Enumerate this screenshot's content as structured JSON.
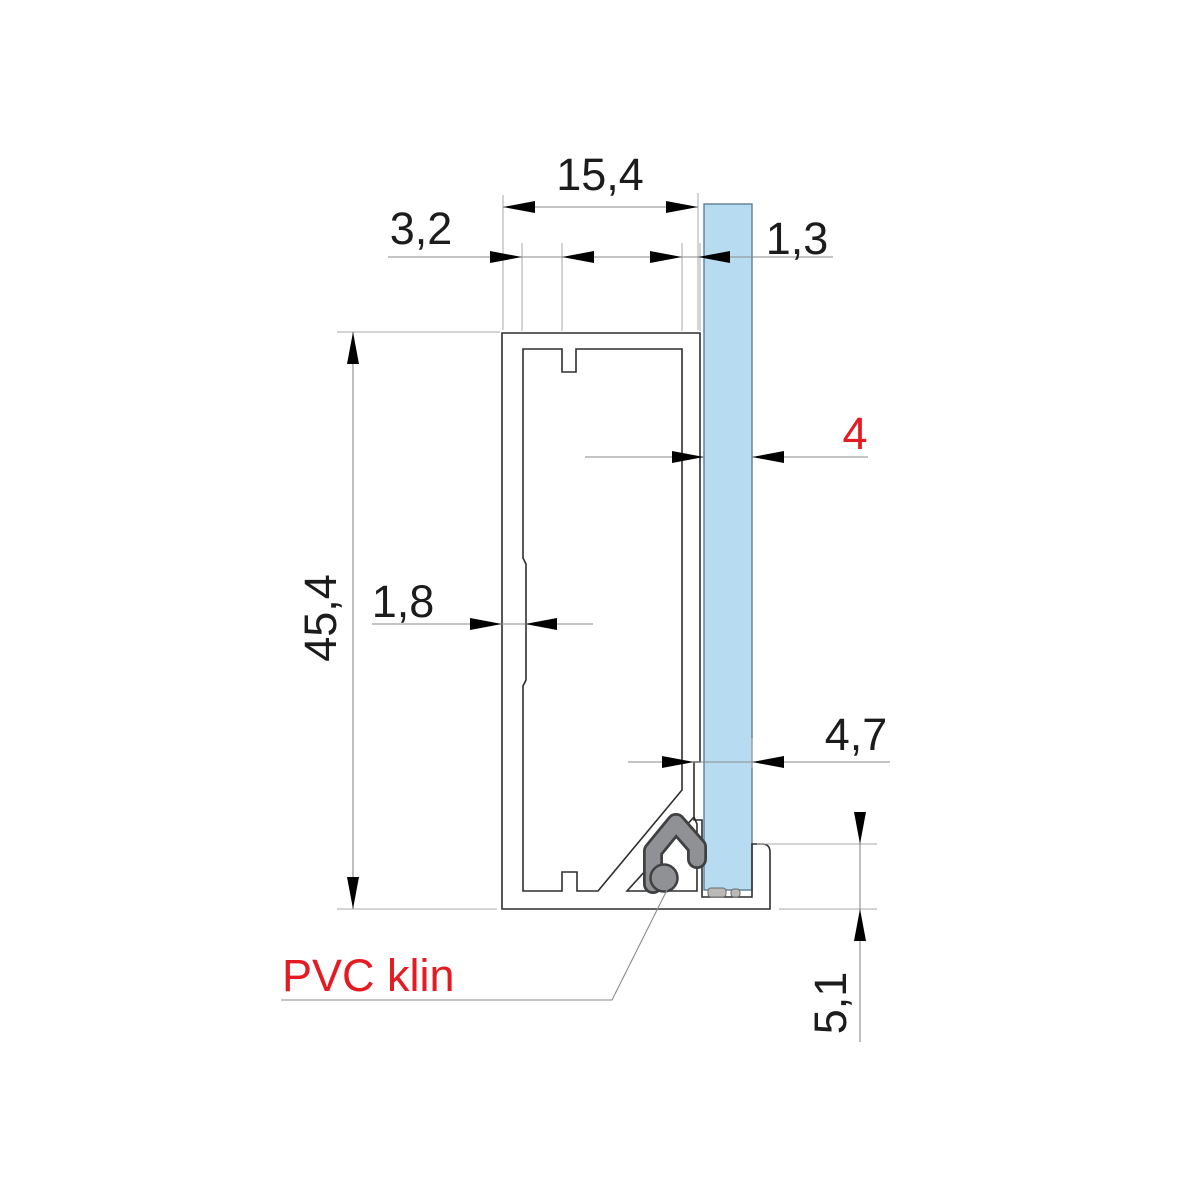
{
  "drawing": {
    "type": "technical-cross-section-glazing-profile",
    "dimensions": {
      "profile_width": "15,4",
      "lip_offset": "3,2",
      "right_wall_thickness": "1,3",
      "glass_thickness": "4",
      "profile_height": "45,4",
      "left_wall_thickness": "1,8",
      "glazing_rebate": "4,7",
      "foot_height": "5,1"
    },
    "labels": {
      "pvc_wedge": "PVC klin"
    },
    "colors": {
      "accent_red": "#e41b22",
      "glass_blue": "#b7dcf2",
      "wedge_gray": "#909194",
      "line_dark": "#2e2e2e",
      "dim_gray": "#8a8a8a"
    }
  }
}
